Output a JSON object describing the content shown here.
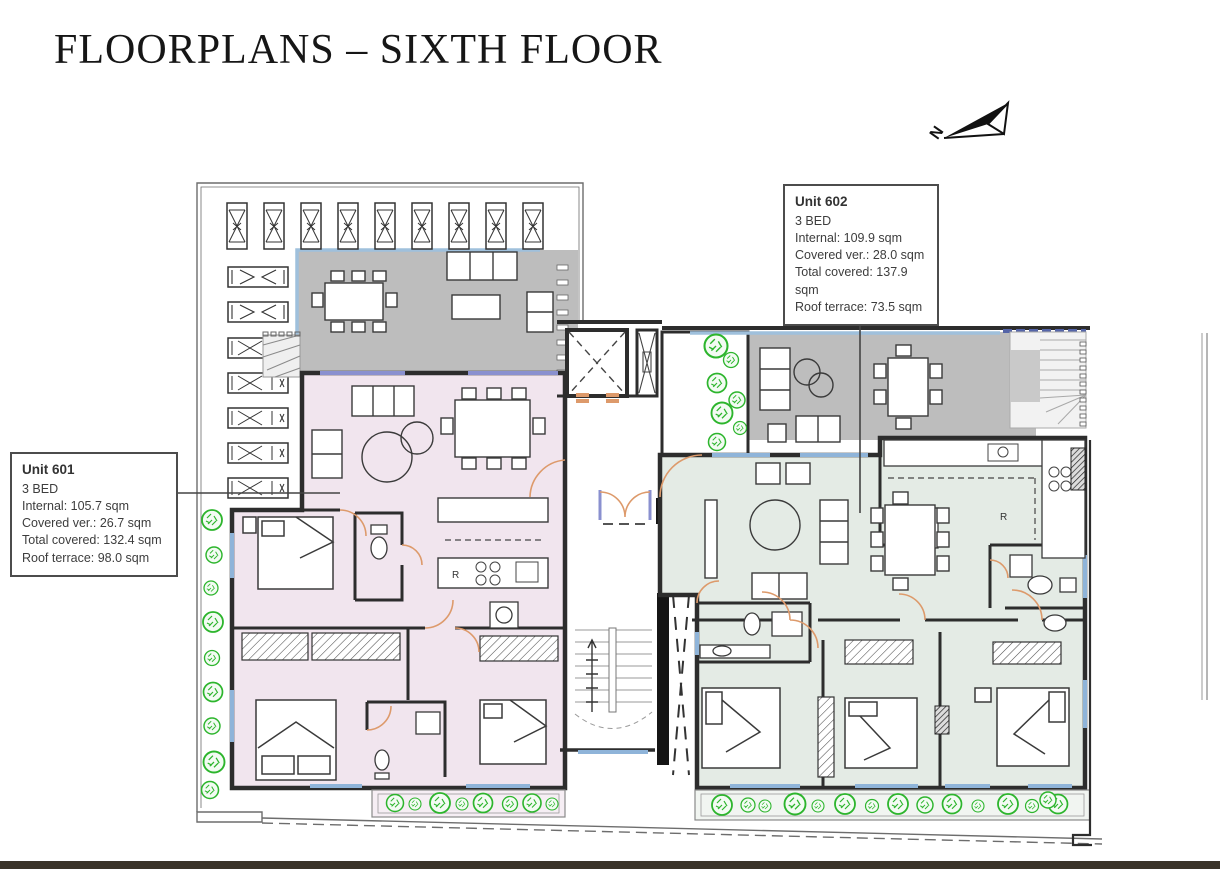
{
  "page": {
    "title": "FLOORPLANS – SIXTH FLOOR"
  },
  "compass": {
    "label": "N"
  },
  "units": {
    "601": {
      "name": "Unit 601",
      "beds": "3 BED",
      "internal": "Internal: 105.7 sqm",
      "covered": "Covered ver.: 26.7 sqm",
      "total": "Total covered: 132.4 sqm",
      "terrace": "Roof terrace: 98.0 sqm"
    },
    "602": {
      "name": "Unit 602",
      "beds": "3 BED",
      "internal": "Internal: 109.9 sqm",
      "covered": "Covered ver.: 28.0 sqm",
      "total": "Total covered: 137.9 sqm",
      "terrace": "Roof terrace: 73.5 sqm"
    }
  },
  "labels": {
    "fridge": "R"
  },
  "colors": {
    "unit601_fill": "#f1e5ee",
    "unit602_fill": "#e4ebe5",
    "terrace_gray": "#bdbdbd",
    "window_blue": "#8fb4d9",
    "door_orange": "#dd9a6b",
    "plant_green": "#2db52d",
    "wall_dark": "#2d2d2d",
    "footer_bar": "#3a3329"
  }
}
